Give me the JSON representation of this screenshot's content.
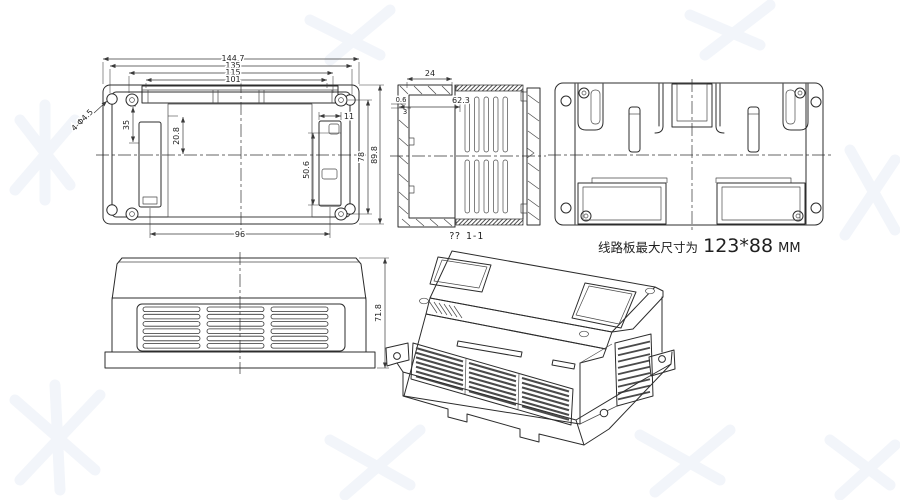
{
  "title": "Enclosure engineering drawing",
  "front": {
    "w1": "144.7",
    "w2": "135",
    "w3": "115",
    "w4": "101",
    "holes": "4-Φ4.5",
    "h_slot": "35",
    "h_pcb": "20.8",
    "slot_w": "11",
    "slot_l": "50.6",
    "h_inner": "78",
    "h_outer": "89.8",
    "slot_span": "96"
  },
  "section": {
    "flange_w": "24",
    "step1": "0.6",
    "step2": "3",
    "depth": "62.3",
    "label": "?? 1-1"
  },
  "side": {
    "height": "71.8"
  },
  "note": {
    "prefix": "线路板最大尺寸为",
    "size": "123*88",
    "unit": "MM"
  },
  "colors": {
    "line": "#2c2c2c",
    "dim_text": "#1f1f1f",
    "watermark": "#f2f5fa",
    "background": "#ffffff"
  }
}
